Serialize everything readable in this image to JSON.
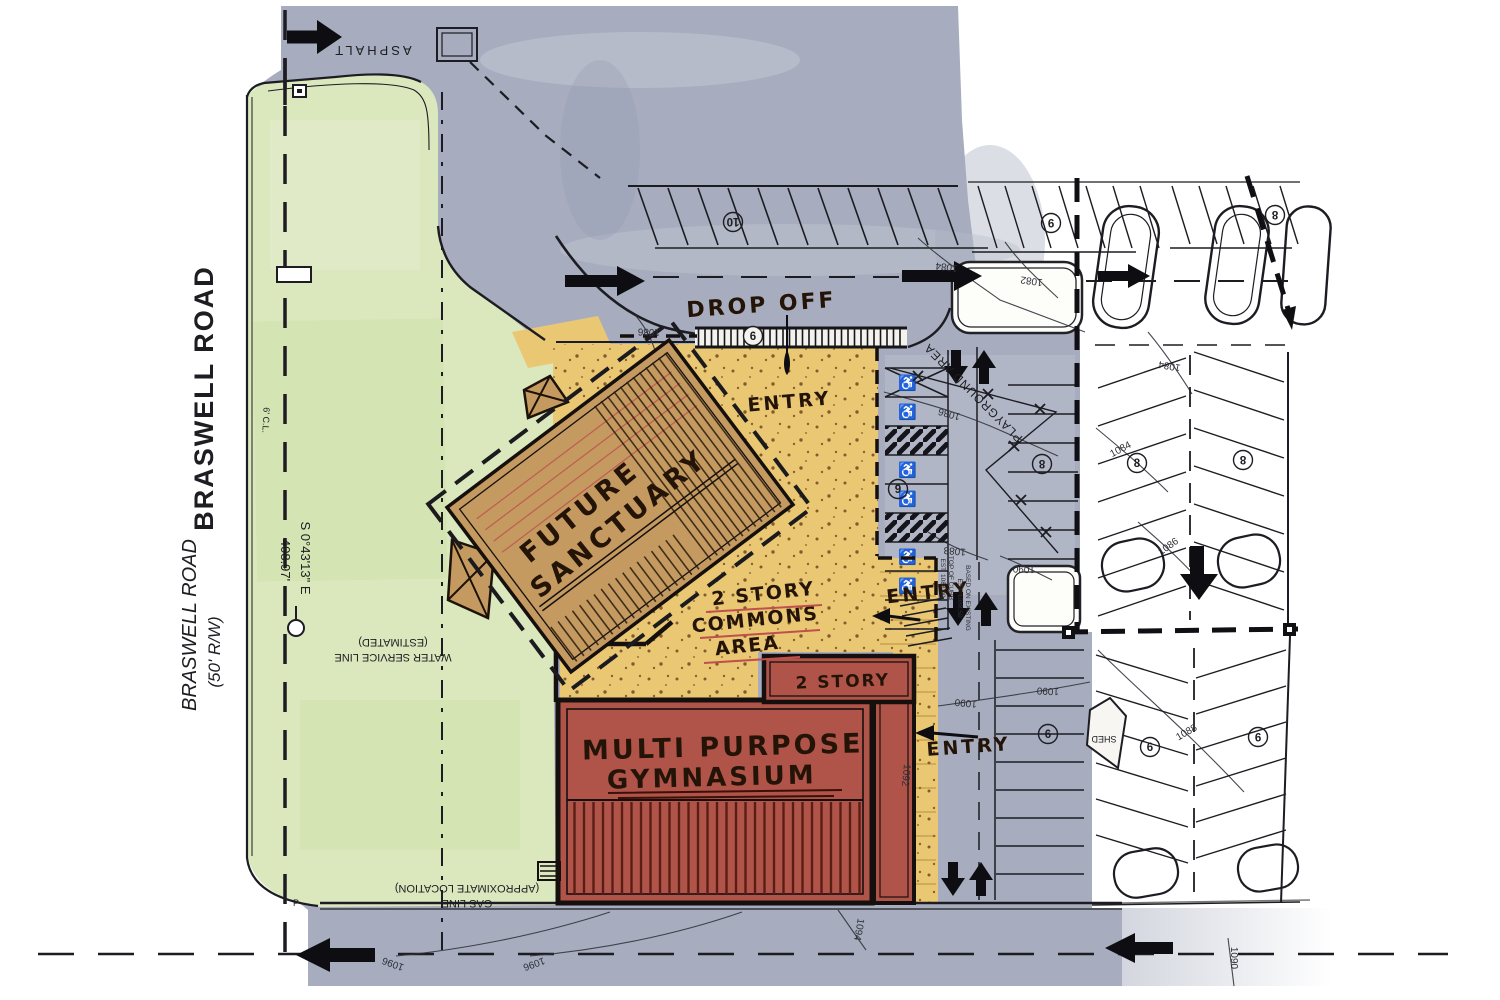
{
  "roads": {
    "braswell_bold": "BRASWELL ROAD",
    "braswell_name": "BRASWELL ROAD",
    "braswell_rw": "(50' R/W)",
    "bearing": "S 0°43'13\" E",
    "distance": "408.97'",
    "asphalt": "ASPHALT",
    "cl_note": "6' C.L.",
    "pole_label": "P"
  },
  "labels": {
    "drop_off": "DROP OFF",
    "entry1": "ENTRY",
    "entry2": "ENTRY",
    "entry3": "ENTRY",
    "playground": "PLAYGROUND AREA",
    "water1": "WATER SERVICE LINE",
    "water2": "(ESTIMATED)",
    "gas1": "GAS LINE",
    "gas2": "(APPROXIMATE LOCATION)",
    "curb_note_a1": "TOP OF CURB",
    "curb_note_a2": "EST. 1088.00",
    "curb_note_b1": "BASED ON EXISTING",
    "curb_note_b2": "EST. 1088.50"
  },
  "buildings": {
    "sanctuary1": "FUTURE",
    "sanctuary2": "SANCTUARY",
    "commons1": "2 STORY",
    "commons2": "COMMONS",
    "commons3": "AREA",
    "gym1": "MULTI PURPOSE",
    "gym2": "GYMNASIUM",
    "two_story": "2 STORY",
    "shed": "SHED"
  },
  "contours": [
    "1084",
    "1082",
    "1084",
    "1084",
    "1086",
    "1086",
    "1086",
    "1088",
    "1088",
    "1090",
    "1090",
    "1090",
    "1090",
    "1092",
    "1094",
    "1096",
    "1096"
  ],
  "stall_counts": [
    "10",
    "9",
    "8",
    "6",
    "9",
    "8",
    "8",
    "8",
    "6",
    "6",
    "9"
  ],
  "icons": {
    "handicap": "♿"
  },
  "colors": {
    "lawn": "#dbe7bd",
    "asphalt": "#a7adbe",
    "walkway": "#eac873",
    "sanctuary": "#c49a60",
    "commons": "#c8a36e",
    "gymnasium": "#b0544a",
    "ink": "#1c1c22",
    "red_accent": "#c0504d"
  }
}
